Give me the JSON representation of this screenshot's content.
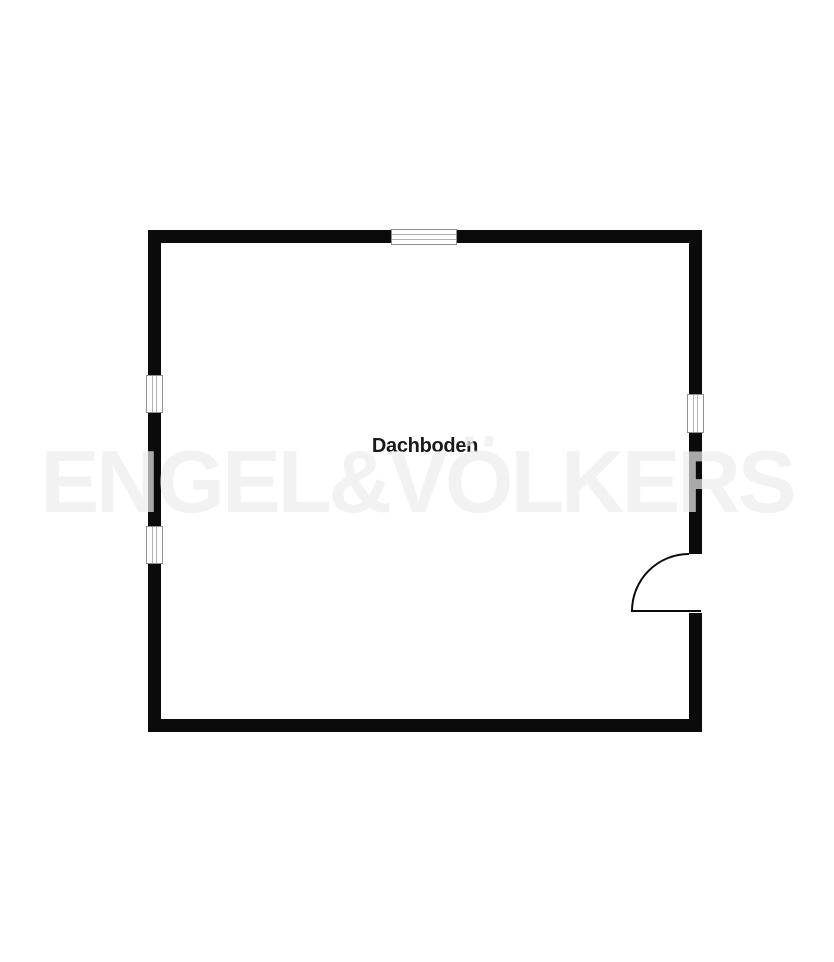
{
  "floorplan": {
    "room": {
      "label": "Dachboden"
    },
    "watermark": {
      "text": "ENGEL&VÖLKERS",
      "apparent_color": "#f2f2f2"
    },
    "elements": {
      "wall_count": 4,
      "window_count": 4,
      "door_count": 1,
      "door_type": "swing-door-quarter-arc"
    },
    "colors": {
      "background": "#ffffff",
      "wall": "#0b0b0b",
      "window_frame": "#8f8f8f",
      "window_glazing": "#b3b3b3",
      "label_text": "#1a1a1a"
    }
  }
}
